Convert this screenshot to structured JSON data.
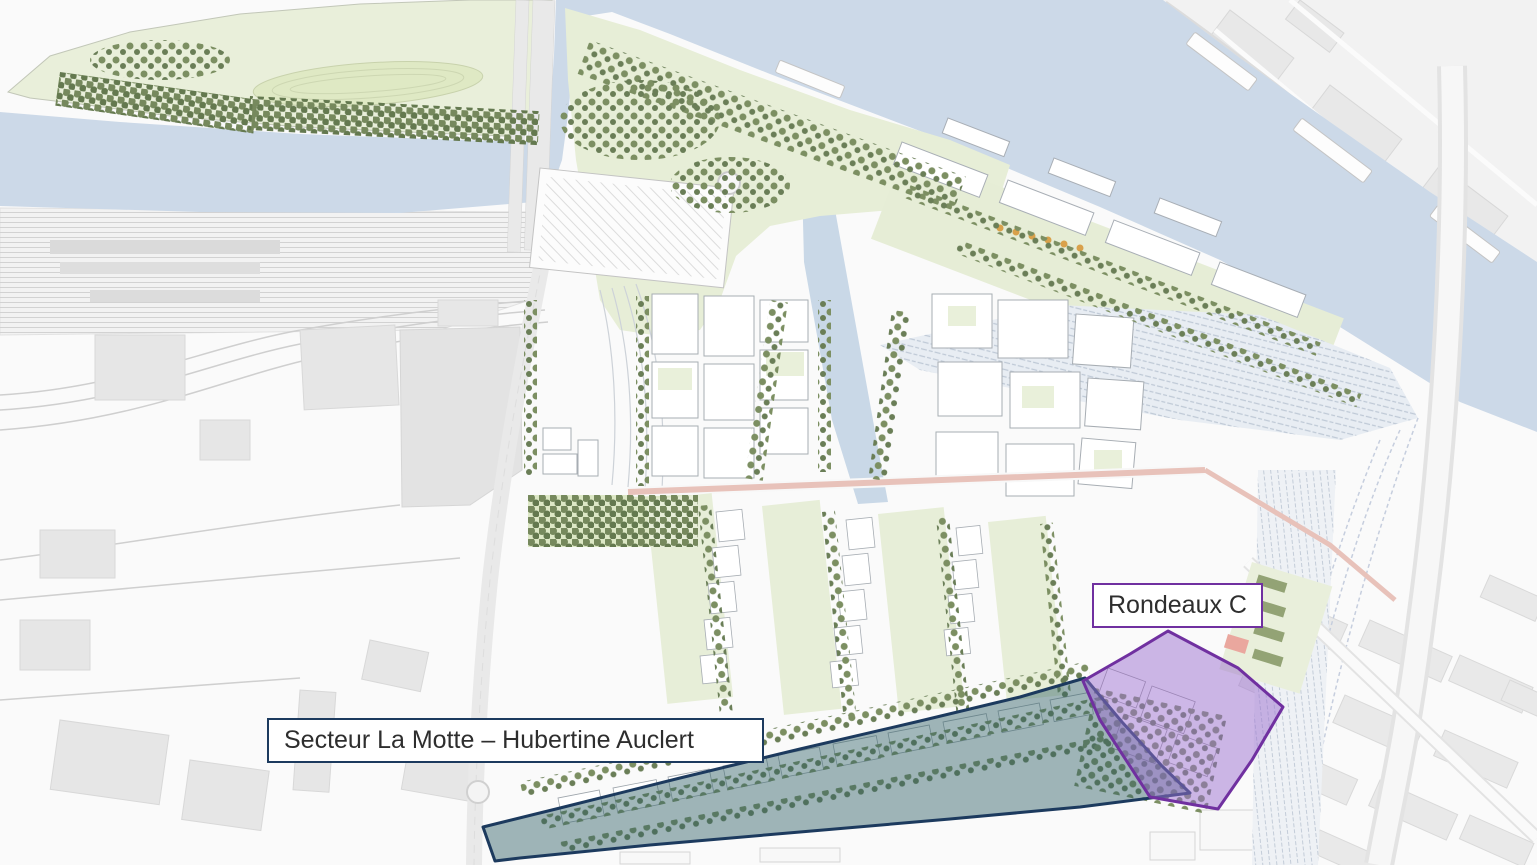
{
  "map": {
    "type": "urban-masterplan-site-plan",
    "zones": [
      {
        "id": "secteur-la-motte-hubertine-auclert",
        "label": "Secteur La Motte – Hubertine Auclert",
        "outline_color": "#1c3a5e",
        "fill_color": "#2e5f66"
      },
      {
        "id": "rondeaux-c",
        "label": "Rondeaux C",
        "outline_color": "#7030a0",
        "fill_color": "#9b6fd0"
      }
    ],
    "palette": {
      "water": "#ccd9e8",
      "park_green": "#e7eed7",
      "tree_green": "#7c8f62",
      "existing_city_gray": "#e9e9e9",
      "new_building_white": "#ffffff",
      "main_street_pink": "#e8c2ba"
    }
  }
}
